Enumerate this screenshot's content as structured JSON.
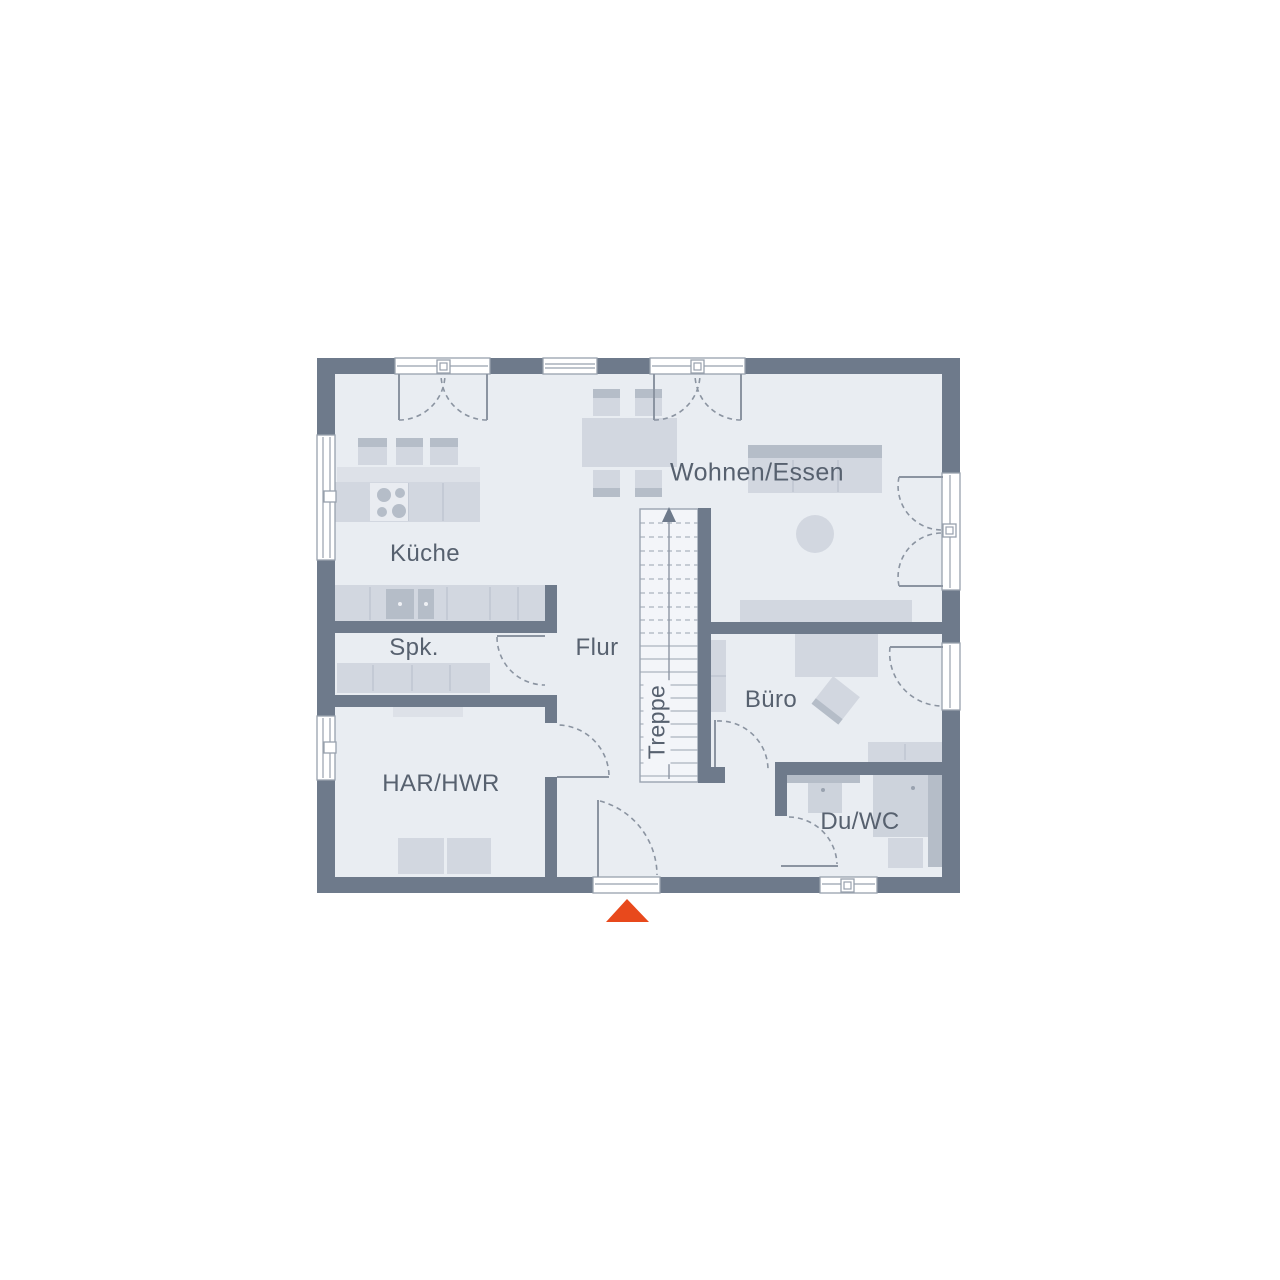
{
  "rooms": {
    "kueche": {
      "label": "Küche"
    },
    "spk": {
      "label": "Spk."
    },
    "flur": {
      "label": "Flur"
    },
    "treppe": {
      "label": "Treppe"
    },
    "har_hwr": {
      "label": "HAR/HWR"
    },
    "wohnen_essen": {
      "label": "Wohnen/Essen"
    },
    "buero": {
      "label": "Büro"
    },
    "du_wc": {
      "label": "Du/WC"
    }
  },
  "icons": {
    "entrance_arrow": "triangle-up",
    "stairs_direction": "arrow-up"
  },
  "colors": {
    "background": "#ffffff",
    "wall": "#6e7a8b",
    "room": "#e9edf2",
    "furniture": "#d2d7e0",
    "furniture_dark": "#b5bdc8",
    "furniture_light": "#dde1e8",
    "fixture": "#cdd3dc",
    "stairs_bg": "#f3f5f9",
    "outline": "#9aa3b0",
    "door_line": "#8b94a1",
    "window_frame": "#98a1ad",
    "label_text": "#57616f",
    "accent": "#e8491c"
  }
}
